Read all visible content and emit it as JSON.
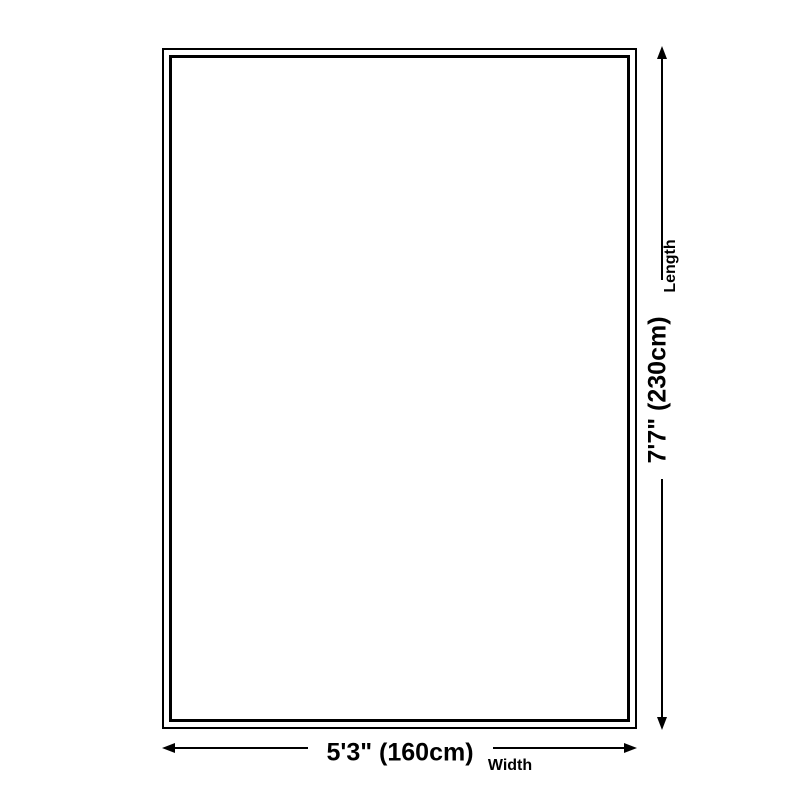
{
  "diagram": {
    "title": "rug-size-diagram",
    "background_color": "#ffffff",
    "line_color": "#000000",
    "rug": {
      "fill_color": "#ffffff",
      "border_color": "#000000",
      "border_style": "double"
    },
    "dimensions": {
      "length": {
        "value": "7'7\" (230cm)",
        "label": "Length",
        "orientation": "vertical"
      },
      "width": {
        "value": "5'3\" (160cm)",
        "label": "Width",
        "orientation": "horizontal"
      }
    }
  }
}
